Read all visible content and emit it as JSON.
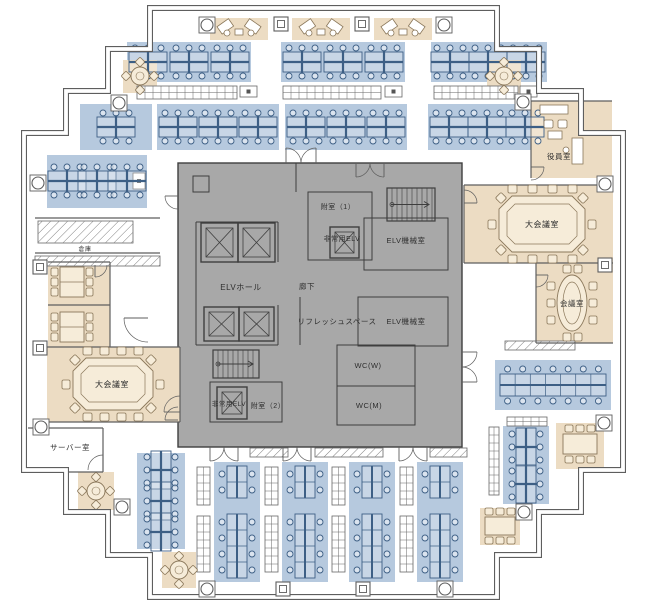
{
  "colors": {
    "wall": "#5e5e5e",
    "core_fill": "#a8a8a8",
    "core_line": "#3e3e3e",
    "office_blue": "#b6c9de",
    "blue_line": "#3d5f85",
    "meeting_beige": "#ecdcc3",
    "beige_line": "#8a775a",
    "table_fill": "#f6ecd9",
    "cabinet_line": "#666666",
    "hatch_line": "#808080",
    "text": "#2f2f2f",
    "white": "#ffffff"
  },
  "outline": "M150,8 L497,8 L497,49 L539,49 L539,91 L581,91 L581,133 L623,133 L623,470 L581,470 L581,512 L539,512 L539,555 L497,555 L497,597 L150,597 L150,555 L108,555 L108,512 L66,512 L66,470 L24,470 L24,133 L66,133 L66,91 L108,91 L108,49 L150,49 Z",
  "zones": [
    {
      "name": "core",
      "x": 178,
      "y": 163,
      "w": 284,
      "h": 284,
      "kind": "core"
    },
    {
      "name": "office-top-row1-a",
      "x": 127,
      "y": 42,
      "w": 124,
      "h": 40,
      "kind": "blue"
    },
    {
      "name": "office-top-row1-b",
      "x": 281,
      "y": 42,
      "w": 124,
      "h": 40,
      "kind": "blue"
    },
    {
      "name": "office-top-row1-c",
      "x": 431,
      "y": 42,
      "w": 116,
      "h": 40,
      "kind": "blue"
    },
    {
      "name": "office-top-row2-a",
      "x": 80,
      "y": 104,
      "w": 72,
      "h": 46,
      "kind": "blue"
    },
    {
      "name": "office-top-row2-b",
      "x": 157,
      "y": 104,
      "w": 122,
      "h": 46,
      "kind": "blue"
    },
    {
      "name": "office-top-row2-c",
      "x": 285,
      "y": 104,
      "w": 122,
      "h": 46,
      "kind": "blue"
    },
    {
      "name": "office-top-row2-d",
      "x": 428,
      "y": 104,
      "w": 120,
      "h": 46,
      "kind": "blue"
    },
    {
      "name": "office-left-mid",
      "x": 47,
      "y": 155,
      "w": 100,
      "h": 53,
      "kind": "blue"
    },
    {
      "name": "office-right-bench",
      "x": 495,
      "y": 360,
      "w": 116,
      "h": 50,
      "kind": "blue"
    },
    {
      "name": "office-right-bottom",
      "x": 503,
      "y": 426,
      "w": 46,
      "h": 78,
      "kind": "blue"
    },
    {
      "name": "office-left-bottom",
      "x": 137,
      "y": 453,
      "w": 48,
      "h": 96,
      "kind": "blue"
    },
    {
      "name": "office-bottom-col1",
      "x": 214,
      "y": 462,
      "w": 46,
      "h": 120,
      "kind": "blue"
    },
    {
      "name": "office-bottom-col2",
      "x": 282,
      "y": 462,
      "w": 46,
      "h": 120,
      "kind": "blue"
    },
    {
      "name": "office-bottom-col3",
      "x": 349,
      "y": 462,
      "w": 46,
      "h": 120,
      "kind": "blue"
    },
    {
      "name": "office-bottom-col4",
      "x": 417,
      "y": 462,
      "w": 46,
      "h": 120,
      "kind": "blue"
    },
    {
      "name": "vestibule-top-a",
      "x": 210,
      "y": 18,
      "w": 58,
      "h": 22,
      "kind": "beige"
    },
    {
      "name": "vestibule-top-b",
      "x": 292,
      "y": 18,
      "w": 58,
      "h": 22,
      "kind": "beige"
    },
    {
      "name": "vestibule-top-c",
      "x": 374,
      "y": 18,
      "w": 58,
      "h": 22,
      "kind": "beige"
    },
    {
      "name": "lounge-top-left",
      "x": 123,
      "y": 60,
      "w": 34,
      "h": 33,
      "kind": "beige"
    },
    {
      "name": "lounge-top-right",
      "x": 487,
      "y": 60,
      "w": 34,
      "h": 33,
      "kind": "beige"
    },
    {
      "name": "room-executive",
      "x": 531,
      "y": 101,
      "w": 81,
      "h": 77,
      "kind": "beige"
    },
    {
      "name": "room-large-meeting-right",
      "x": 464,
      "y": 185,
      "w": 149,
      "h": 78,
      "kind": "beige"
    },
    {
      "name": "room-meeting-right",
      "x": 536,
      "y": 263,
      "w": 77,
      "h": 80,
      "kind": "beige"
    },
    {
      "name": "room-small-meeting-left",
      "x": 48,
      "y": 262,
      "w": 62,
      "h": 85,
      "kind": "beige"
    },
    {
      "name": "room-large-meeting-left",
      "x": 47,
      "y": 347,
      "w": 133,
      "h": 75,
      "kind": "beige"
    },
    {
      "name": "lounge-bottom-left-1",
      "x": 78,
      "y": 472,
      "w": 36,
      "h": 38,
      "kind": "beige"
    },
    {
      "name": "lounge-bottom-left-2",
      "x": 162,
      "y": 552,
      "w": 34,
      "h": 36,
      "kind": "beige"
    },
    {
      "name": "lounge-bottom-right-1",
      "x": 556,
      "y": 423,
      "w": 48,
      "h": 46,
      "kind": "beige"
    },
    {
      "name": "lounge-bottom-right-2",
      "x": 480,
      "y": 508,
      "w": 40,
      "h": 37,
      "kind": "beige"
    }
  ],
  "walls": [
    [
      531,
      101,
      531,
      178
    ],
    [
      531,
      101,
      612,
      101
    ],
    [
      464,
      185,
      613,
      185
    ],
    [
      464,
      185,
      464,
      263
    ],
    [
      464,
      263,
      613,
      263
    ],
    [
      536,
      263,
      536,
      343
    ],
    [
      536,
      343,
      613,
      343
    ],
    [
      48,
      262,
      110,
      262
    ],
    [
      110,
      262,
      110,
      347
    ],
    [
      48,
      305,
      110,
      305
    ],
    [
      47,
      347,
      180,
      347
    ],
    [
      180,
      347,
      180,
      422
    ],
    [
      47,
      422,
      180,
      422
    ],
    [
      28,
      428,
      103,
      428
    ],
    [
      103,
      428,
      103,
      472
    ],
    [
      28,
      472,
      103,
      472
    ],
    [
      35,
      218,
      160,
      218
    ],
    [
      35,
      253,
      160,
      253
    ]
  ],
  "core": {
    "rects": [
      {
        "x": 308,
        "y": 192,
        "w": 64,
        "h": 68
      },
      {
        "x": 364,
        "y": 218,
        "w": 84,
        "h": 52
      },
      {
        "x": 358,
        "y": 297,
        "w": 90,
        "h": 49
      },
      {
        "x": 337,
        "y": 345,
        "w": 78,
        "h": 80
      },
      {
        "x": 210,
        "y": 382,
        "w": 72,
        "h": 40
      },
      {
        "x": 193,
        "y": 176,
        "w": 16,
        "h": 16
      }
    ],
    "segs": [
      [
        196,
        222,
        278,
        222
      ],
      [
        196,
        222,
        196,
        345
      ],
      [
        196,
        345,
        278,
        345
      ],
      [
        278,
        222,
        278,
        262
      ],
      [
        278,
        305,
        278,
        345
      ],
      [
        337,
        386,
        415,
        386
      ],
      [
        300,
        297,
        300,
        345
      ],
      [
        296,
        163,
        296,
        192
      ]
    ]
  },
  "elevators": [
    {
      "x": 201,
      "y": 223,
      "w": 37,
      "h": 39
    },
    {
      "x": 238,
      "y": 223,
      "w": 37,
      "h": 39
    },
    {
      "x": 204,
      "y": 307,
      "w": 35,
      "h": 34
    },
    {
      "x": 239,
      "y": 307,
      "w": 35,
      "h": 34
    },
    {
      "x": 330,
      "y": 227,
      "w": 29,
      "h": 31
    },
    {
      "x": 217,
      "y": 387,
      "w": 30,
      "h": 32
    }
  ],
  "stairs": [
    {
      "x": 387,
      "y": 188,
      "w": 48,
      "h": 33
    },
    {
      "x": 213,
      "y": 350,
      "w": 46,
      "h": 28
    }
  ],
  "clusters_h": [
    [
      148,
      62
    ],
    [
      189,
      62
    ],
    [
      230,
      62
    ],
    [
      302,
      62
    ],
    [
      343,
      62
    ],
    [
      384,
      62
    ],
    [
      450,
      62
    ],
    [
      488,
      62
    ],
    [
      526,
      62
    ],
    [
      116,
      127
    ],
    [
      178,
      127
    ],
    [
      218,
      127
    ],
    [
      258,
      127
    ],
    [
      306,
      127
    ],
    [
      346,
      127
    ],
    [
      386,
      127
    ],
    [
      449,
      127
    ],
    [
      487,
      127
    ],
    [
      525,
      127
    ],
    [
      67,
      181
    ],
    [
      97,
      181
    ],
    [
      127,
      181
    ]
  ],
  "clusters_v": [
    [
      161,
      470
    ],
    [
      161,
      501
    ],
    [
      161,
      532
    ],
    [
      526,
      447
    ],
    [
      526,
      484
    ]
  ],
  "bench_cols": [
    {
      "cx": 237,
      "y": 466,
      "rows": 2
    },
    {
      "cx": 237,
      "y": 514,
      "rows": 4
    },
    {
      "cx": 305,
      "y": 466,
      "rows": 2
    },
    {
      "cx": 305,
      "y": 514,
      "rows": 4
    },
    {
      "cx": 372,
      "y": 466,
      "rows": 2
    },
    {
      "cx": 372,
      "y": 514,
      "rows": 4
    },
    {
      "cx": 440,
      "y": 466,
      "rows": 2
    },
    {
      "cx": 440,
      "y": 514,
      "rows": 4
    }
  ],
  "bench_rows": [
    {
      "x": 500,
      "y": 374,
      "w": 106,
      "h": 22,
      "seats": 7
    }
  ],
  "vestibule_desks": [
    [
      210,
      18
    ],
    [
      292,
      18
    ],
    [
      374,
      18
    ]
  ],
  "tables": {
    "octagon": [
      {
        "cx": 542,
        "cy": 224,
        "w": 86,
        "h": 56
      },
      {
        "cx": 113,
        "cy": 384,
        "w": 80,
        "h": 52
      }
    ],
    "oval": [
      {
        "cx": 572,
        "cy": 303,
        "rx": 15,
        "ry": 28
      }
    ],
    "rect_v": [
      {
        "cx": 72,
        "cy": 282,
        "w": 24,
        "h": 30
      },
      {
        "cx": 72,
        "cy": 327,
        "w": 24,
        "h": 30
      }
    ],
    "rect_h": [
      {
        "cx": 580,
        "cy": 444,
        "w": 34,
        "h": 20
      },
      {
        "cx": 500,
        "cy": 526,
        "w": 30,
        "h": 18
      }
    ],
    "round": [
      {
        "cx": 140,
        "cy": 76
      },
      {
        "cx": 504,
        "cy": 76
      },
      {
        "cx": 96,
        "cy": 491
      },
      {
        "cx": 179,
        "cy": 570
      }
    ]
  },
  "exec_furniture": {
    "cabinet": {
      "x": 540,
      "y": 105,
      "w": 28,
      "h": 9
    },
    "sofas": [
      {
        "x": 544,
        "y": 120,
        "w": 9,
        "h": 8
      },
      {
        "x": 558,
        "y": 120,
        "w": 9,
        "h": 8
      }
    ],
    "low_table": {
      "x": 548,
      "y": 131,
      "w": 14,
      "h": 8
    },
    "desk": {
      "x": 572,
      "y": 138,
      "w": 11,
      "h": 26
    },
    "chair": {
      "cx": 566,
      "cy": 150
    }
  },
  "cabinets": [
    {
      "x": 137,
      "y": 86,
      "w": 100,
      "h": 13
    },
    {
      "x": 283,
      "y": 86,
      "w": 98,
      "h": 13
    },
    {
      "x": 434,
      "y": 86,
      "w": 84,
      "h": 13
    },
    {
      "x": 197,
      "y": 467,
      "w": 13,
      "h": 38
    },
    {
      "x": 197,
      "y": 516,
      "w": 13,
      "h": 56
    },
    {
      "x": 265,
      "y": 467,
      "w": 13,
      "h": 38
    },
    {
      "x": 265,
      "y": 516,
      "w": 13,
      "h": 56
    },
    {
      "x": 332,
      "y": 467,
      "w": 13,
      "h": 38
    },
    {
      "x": 332,
      "y": 516,
      "w": 13,
      "h": 56
    },
    {
      "x": 400,
      "y": 467,
      "w": 13,
      "h": 38
    },
    {
      "x": 400,
      "y": 516,
      "w": 13,
      "h": 56
    },
    {
      "x": 489,
      "y": 427,
      "w": 10,
      "h": 68
    },
    {
      "x": 507,
      "y": 417,
      "w": 40,
      "h": 9
    }
  ],
  "hatched": [
    {
      "x": 38,
      "y": 221,
      "w": 95,
      "h": 22
    },
    {
      "x": 35,
      "y": 256,
      "w": 125,
      "h": 10
    },
    {
      "x": 250,
      "y": 448,
      "w": 38,
      "h": 9
    },
    {
      "x": 315,
      "y": 448,
      "w": 68,
      "h": 9
    },
    {
      "x": 430,
      "y": 448,
      "w": 37,
      "h": 9
    },
    {
      "x": 505,
      "y": 341,
      "w": 70,
      "h": 9
    }
  ],
  "label_boxes": [
    {
      "x": 240,
      "y": 86,
      "w": 17,
      "h": 11
    },
    {
      "x": 385,
      "y": 86,
      "w": 17,
      "h": 11
    },
    {
      "x": 520,
      "y": 86,
      "w": 17,
      "h": 11
    },
    {
      "x": 133,
      "y": 173,
      "w": 12,
      "h": 16
    }
  ],
  "doors": [
    {
      "x": 286,
      "y": 163,
      "w": 15,
      "o": "ur"
    },
    {
      "x": 316,
      "y": 163,
      "w": 15,
      "o": "ul"
    },
    {
      "x": 356,
      "y": 163,
      "w": 14,
      "o": "dr"
    },
    {
      "x": 384,
      "y": 163,
      "w": 14,
      "o": "dl"
    },
    {
      "x": 210,
      "y": 447,
      "w": 14,
      "o": "dr"
    },
    {
      "x": 238,
      "y": 447,
      "w": 14,
      "o": "dl"
    },
    {
      "x": 283,
      "y": 447,
      "w": 14,
      "o": "dr"
    },
    {
      "x": 311,
      "y": 447,
      "w": 14,
      "o": "dl"
    },
    {
      "x": 399,
      "y": 447,
      "w": 14,
      "o": "dr"
    },
    {
      "x": 427,
      "y": 447,
      "w": 14,
      "o": "dl"
    },
    {
      "x": 462,
      "y": 352,
      "w": 15,
      "o": "rd"
    },
    {
      "x": 462,
      "y": 382,
      "w": 15,
      "o": "ru"
    },
    {
      "x": 178,
      "y": 196,
      "w": 13,
      "o": "ld"
    },
    {
      "x": 178,
      "y": 420,
      "w": 13,
      "o": "lu"
    },
    {
      "x": 103,
      "y": 470,
      "w": 15,
      "o": "ul"
    },
    {
      "x": 531,
      "y": 167,
      "w": 13,
      "o": "rd"
    },
    {
      "x": 464,
      "y": 203,
      "w": 13,
      "o": "ru"
    },
    {
      "x": 536,
      "y": 275,
      "w": 12,
      "o": "rd"
    },
    {
      "x": 180,
      "y": 412,
      "w": 16,
      "o": "lu"
    },
    {
      "x": 148,
      "y": 318,
      "w": 24,
      "o": "ld"
    },
    {
      "x": 95,
      "y": 265,
      "w": 12,
      "o": "dr"
    }
  ],
  "columns": {
    "circle": [
      [
        207,
        25
      ],
      [
        444,
        25
      ],
      [
        523,
        102
      ],
      [
        605,
        184
      ],
      [
        604,
        423
      ],
      [
        524,
        512
      ],
      [
        445,
        589
      ],
      [
        207,
        589
      ],
      [
        122,
        507
      ],
      [
        41,
        427
      ],
      [
        38,
        183
      ],
      [
        119,
        103
      ]
    ],
    "square": [
      [
        281,
        24
      ],
      [
        362,
        24
      ],
      [
        605,
        265
      ],
      [
        40,
        267
      ],
      [
        40,
        348
      ],
      [
        283,
        589
      ],
      [
        363,
        589
      ]
    ]
  },
  "labels": [
    {
      "text": "附室（1）",
      "x": 338,
      "y": 209,
      "fs": 7
    },
    {
      "text": "非常用ELV",
      "x": 342,
      "y": 241,
      "fs": 7
    },
    {
      "text": "ELV機械室",
      "x": 406,
      "y": 243,
      "fs": 7.5
    },
    {
      "text": "ELVホール",
      "x": 241,
      "y": 290,
      "fs": 8
    },
    {
      "text": "廊下",
      "x": 307,
      "y": 289,
      "fs": 7.5
    },
    {
      "text": "リフレッシュスペース",
      "x": 337,
      "y": 324,
      "fs": 7.5
    },
    {
      "text": "ELV機械室",
      "x": 406,
      "y": 324,
      "fs": 7.5
    },
    {
      "text": "WC(W)",
      "x": 368,
      "y": 368,
      "fs": 7.5
    },
    {
      "text": "WC(M)",
      "x": 369,
      "y": 408,
      "fs": 7.5
    },
    {
      "text": "非常用ELV",
      "x": 229,
      "y": 406,
      "fs": 6.5
    },
    {
      "text": "附室（2）",
      "x": 268,
      "y": 408,
      "fs": 7
    },
    {
      "text": "役員室",
      "x": 559,
      "y": 159,
      "fs": 7.5
    },
    {
      "text": "大会議室",
      "x": 542,
      "y": 227,
      "fs": 8
    },
    {
      "text": "会議室",
      "x": 572,
      "y": 306,
      "fs": 7.5
    },
    {
      "text": "大会議室",
      "x": 112,
      "y": 387,
      "fs": 8
    },
    {
      "text": "サーバー室",
      "x": 70,
      "y": 450,
      "fs": 7.5
    },
    {
      "text": "倉庫",
      "x": 85,
      "y": 251,
      "fs": 6
    }
  ]
}
